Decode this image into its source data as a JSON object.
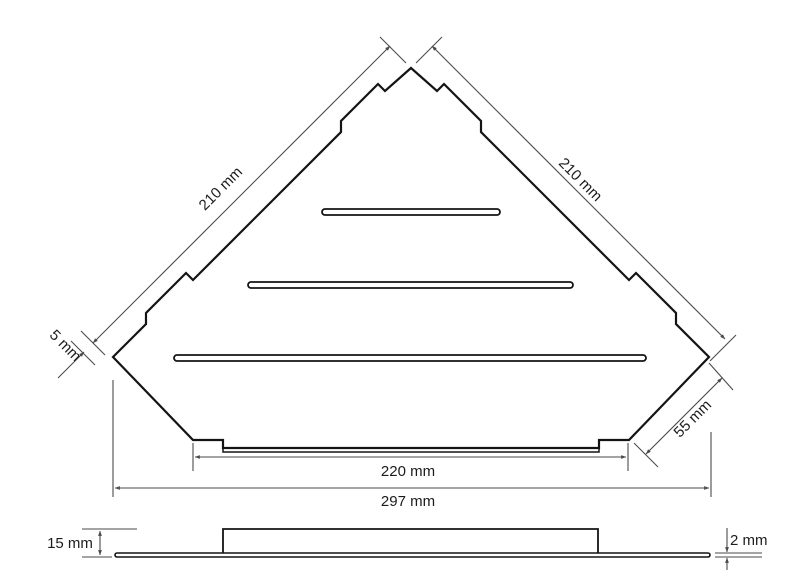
{
  "drawing": {
    "type": "technical-dimension-drawing",
    "views": {
      "top_view": {
        "dim_left_edge": "210 mm",
        "dim_right_edge": "210 mm",
        "dim_corner_step": "5 mm",
        "dim_corner_cut": "55 mm",
        "dim_inner_width": "220 mm",
        "dim_overall_width": "297 mm"
      },
      "side_view": {
        "dim_height": "15 mm",
        "dim_thickness": "2 mm"
      }
    },
    "colors": {
      "outline": "#141414",
      "dimension_line": "#4a4a4a",
      "background": "#ffffff"
    }
  }
}
